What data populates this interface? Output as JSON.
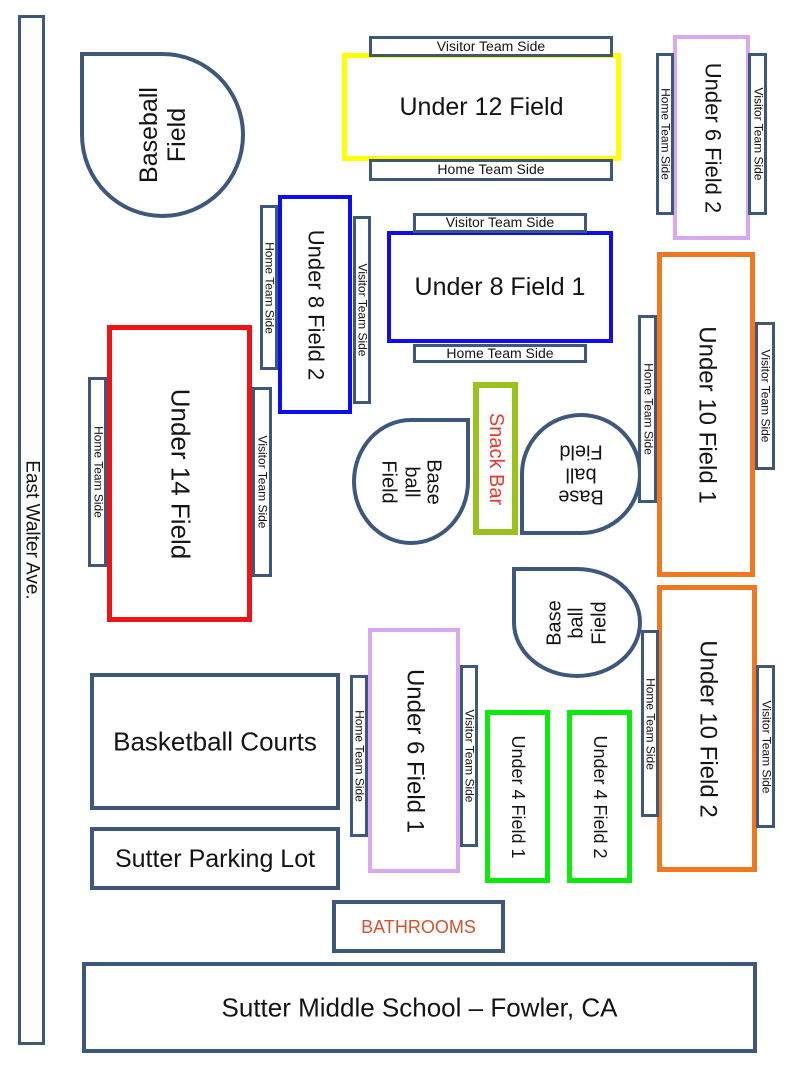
{
  "title": "Sutter Middle School – Fowler, CA",
  "colors": {
    "outline_blue": "#3e587d",
    "under12_yellow": "#ffff00",
    "under8_blue": "#0d0df0",
    "under14_red": "#ee1414",
    "under10_orange": "#ef7820",
    "under6_violet": "#d8a8f0",
    "under4_green": "#0de80d",
    "snackbar_green": "#9ac11c",
    "snackbar_text_red": "#e8392e",
    "bathrooms_text_red": "#d9502e"
  },
  "street": {
    "label": "East Walter Ave."
  },
  "strips": {
    "home": "Home Team Side",
    "visitor": "Visitor Team Side"
  },
  "baseball": {
    "lines": [
      "Base",
      "ball",
      "Field"
    ]
  },
  "fields": {
    "baseball_nw": {
      "lines": [
        "Baseball",
        "Field"
      ]
    },
    "under12": {
      "label": "Under 12 Field"
    },
    "under6_2": {
      "label": "Under 6 Field 2"
    },
    "under8_2": {
      "label": "Under 8 Field 2"
    },
    "under8_1": {
      "label": "Under 8 Field 1"
    },
    "under14": {
      "label": "Under 14 Field"
    },
    "under10_1": {
      "label": "Under 10 Field 1"
    },
    "under10_2": {
      "label": "Under 10 Field 2"
    },
    "under6_1": {
      "label": "Under 6 Field 1"
    },
    "under4_1": {
      "label": "Under 4 Field 1"
    },
    "under4_2": {
      "label": "Under 4 Field 2"
    }
  },
  "snack_bar": {
    "label": "Snack Bar"
  },
  "facilities": {
    "basketball": "Basketball Courts",
    "parking": "Sutter Parking Lot",
    "bathrooms": "BATHROOMS",
    "school": "Sutter Middle School – Fowler, CA"
  }
}
